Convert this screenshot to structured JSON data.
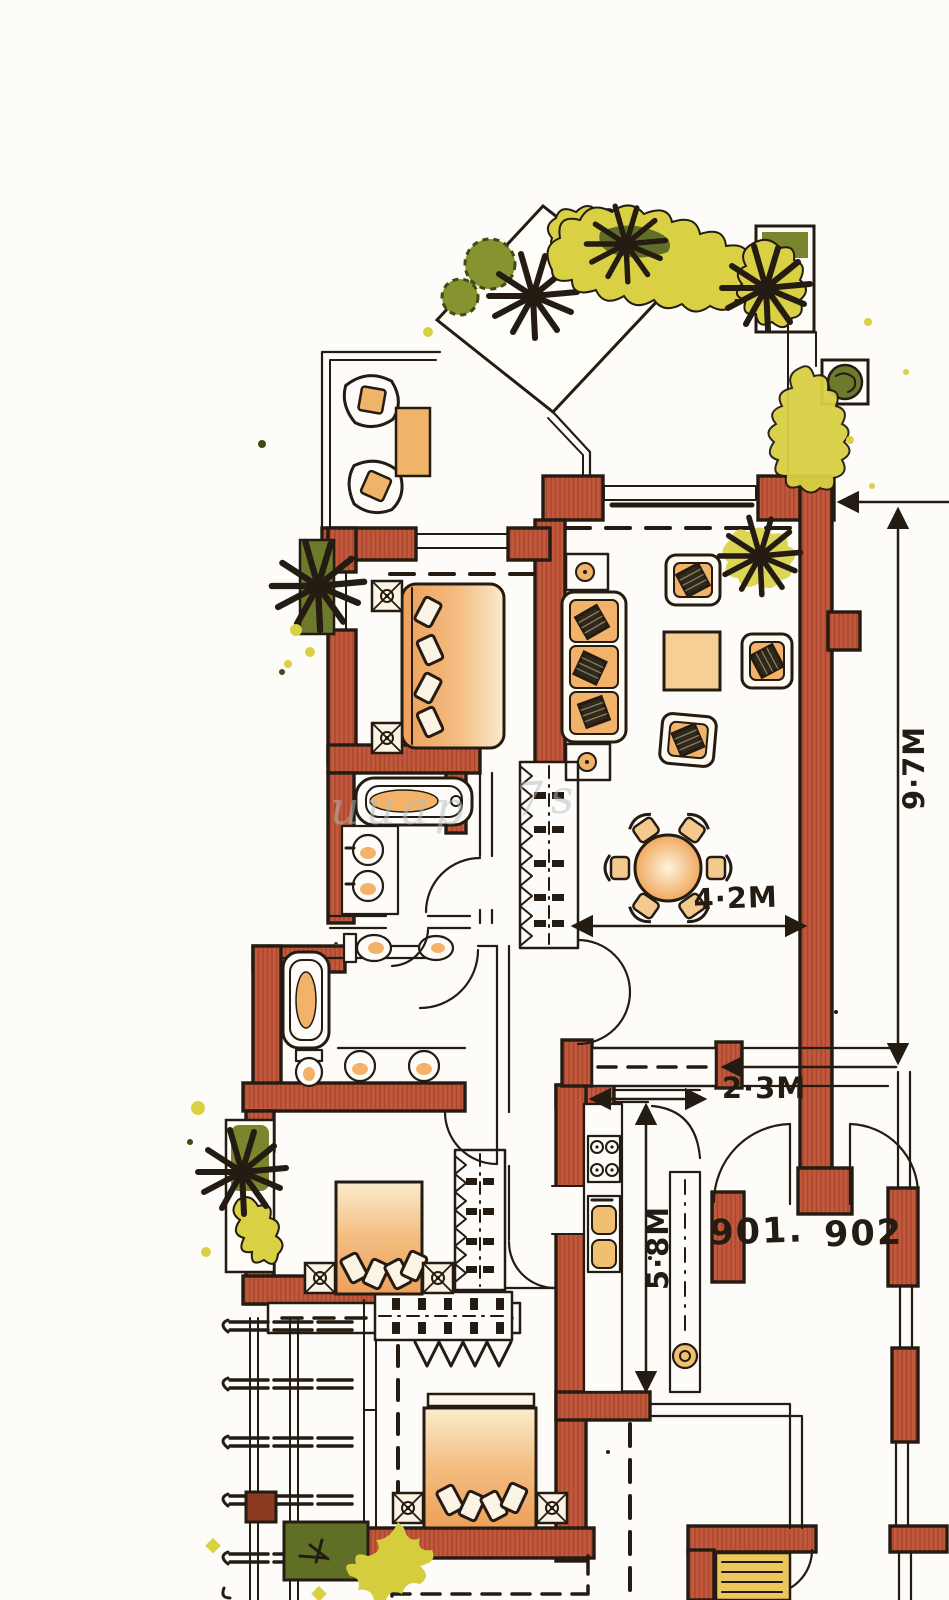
{
  "labels": {
    "unit_left": "901.",
    "unit_right": "902"
  },
  "dimensions": {
    "living_height": "9·7M",
    "dining_width": "4·2M",
    "walkway_width": "2·3M",
    "kitchen_height": "5·8M"
  },
  "watermark": {
    "part1": "uuap",
    "part2": "7s"
  },
  "colors": {
    "paper": "#fdfcf8",
    "ink": "#241b12",
    "wall_terracotta": "#c3593c",
    "wall_hatch": "#a9482e",
    "furniture_orange": "#efa55e",
    "furniture_light": "#f8e3bd",
    "vegetation_yellow": "#d9d044",
    "vegetation_olive": "#79862e",
    "tree_dark": "#47581f",
    "watermark_gray": "#b3bcbf"
  }
}
